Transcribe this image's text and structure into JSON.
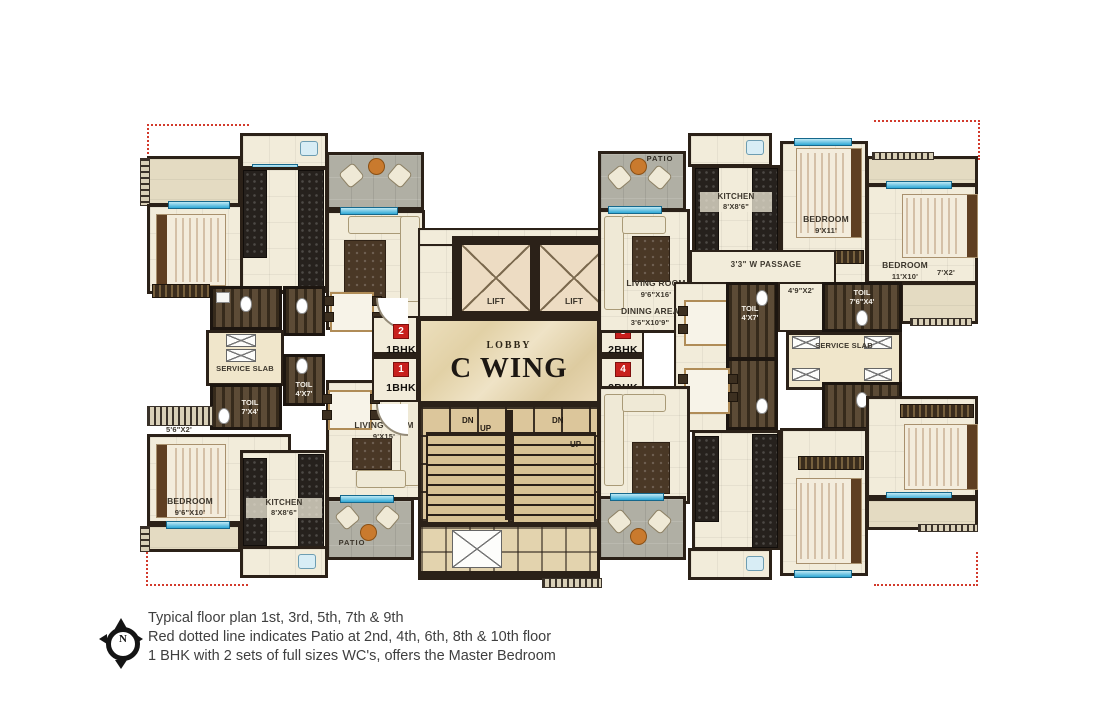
{
  "center": {
    "lobby": "LOBBY",
    "wing": "C WING",
    "lift": "LIFT",
    "dn": "DN",
    "up": "UP"
  },
  "markers": [
    {
      "num": "2",
      "type": "1BHK"
    },
    {
      "num": "1",
      "type": "1BHK"
    },
    {
      "num": "3",
      "type": "2BHK"
    },
    {
      "num": "4",
      "type": "2BHK"
    }
  ],
  "left": {
    "service_slab": "SERVICE SLAB",
    "toil1_name": "TOIL",
    "toil1_dim": "7'X4'",
    "toil2_name": "TOIL",
    "toil2_dim": "4'X7'",
    "living_name": "LIVING ROOM",
    "living_dim": "9'X15'",
    "bedroom_name": "BEDROOM",
    "bedroom_dim": "9'6\"X10'",
    "kitchen_name": "KITCHEN",
    "kitchen_dim": "8'X8'6\"",
    "patio": "PATIO",
    "balc_dim": "5'6\"X2'"
  },
  "right": {
    "patio": "PATIO",
    "kitchen_name": "KITCHEN",
    "kitchen_dim": "8'X8'6\"",
    "bedroom1_name": "BEDROOM",
    "bedroom1_dim": "9'X11'",
    "bedroom2_name": "BEDROOM",
    "bedroom2_dim": "11'X10'",
    "balc_dim": "7'X2'",
    "living_name": "LIVING ROOM",
    "living_dim": "9'6\"X16'",
    "dining_name": "DINING AREA",
    "dining_dim": "3'6\"X10'9\"",
    "passage": "3'3\" W PASSAGE",
    "toil1_name": "TOIL",
    "toil1_dim": "4'X7'",
    "pass_dim": "4'9\"X2'",
    "toil2_name": "TOIL",
    "toil2_dim": "7'6\"X4'",
    "service_slab": "SERVICE SLAB"
  },
  "legend": {
    "compass": "N",
    "notes": [
      "Typical floor plan 1st, 3rd, 5th, 7th & 9th",
      "Red dotted line indicates Patio at 2nd, 4th, 6th, 8th & 10th floor",
      "1 BHK with 2 sets of full sizes WC's, offers the Master Bedroom"
    ]
  },
  "colors": {
    "wall": "#2b2118",
    "floor": "#f2ecda",
    "lobby_marble": "#e7d9b4",
    "stairs": "#d8c294",
    "patio": "#b0afa4",
    "toilet_wood": "#52402a",
    "bed_orange": "#e0813c",
    "window_blue": "#2fa8d5",
    "marker_red": "#c8201d",
    "dotted_red": "#d23a2c"
  }
}
